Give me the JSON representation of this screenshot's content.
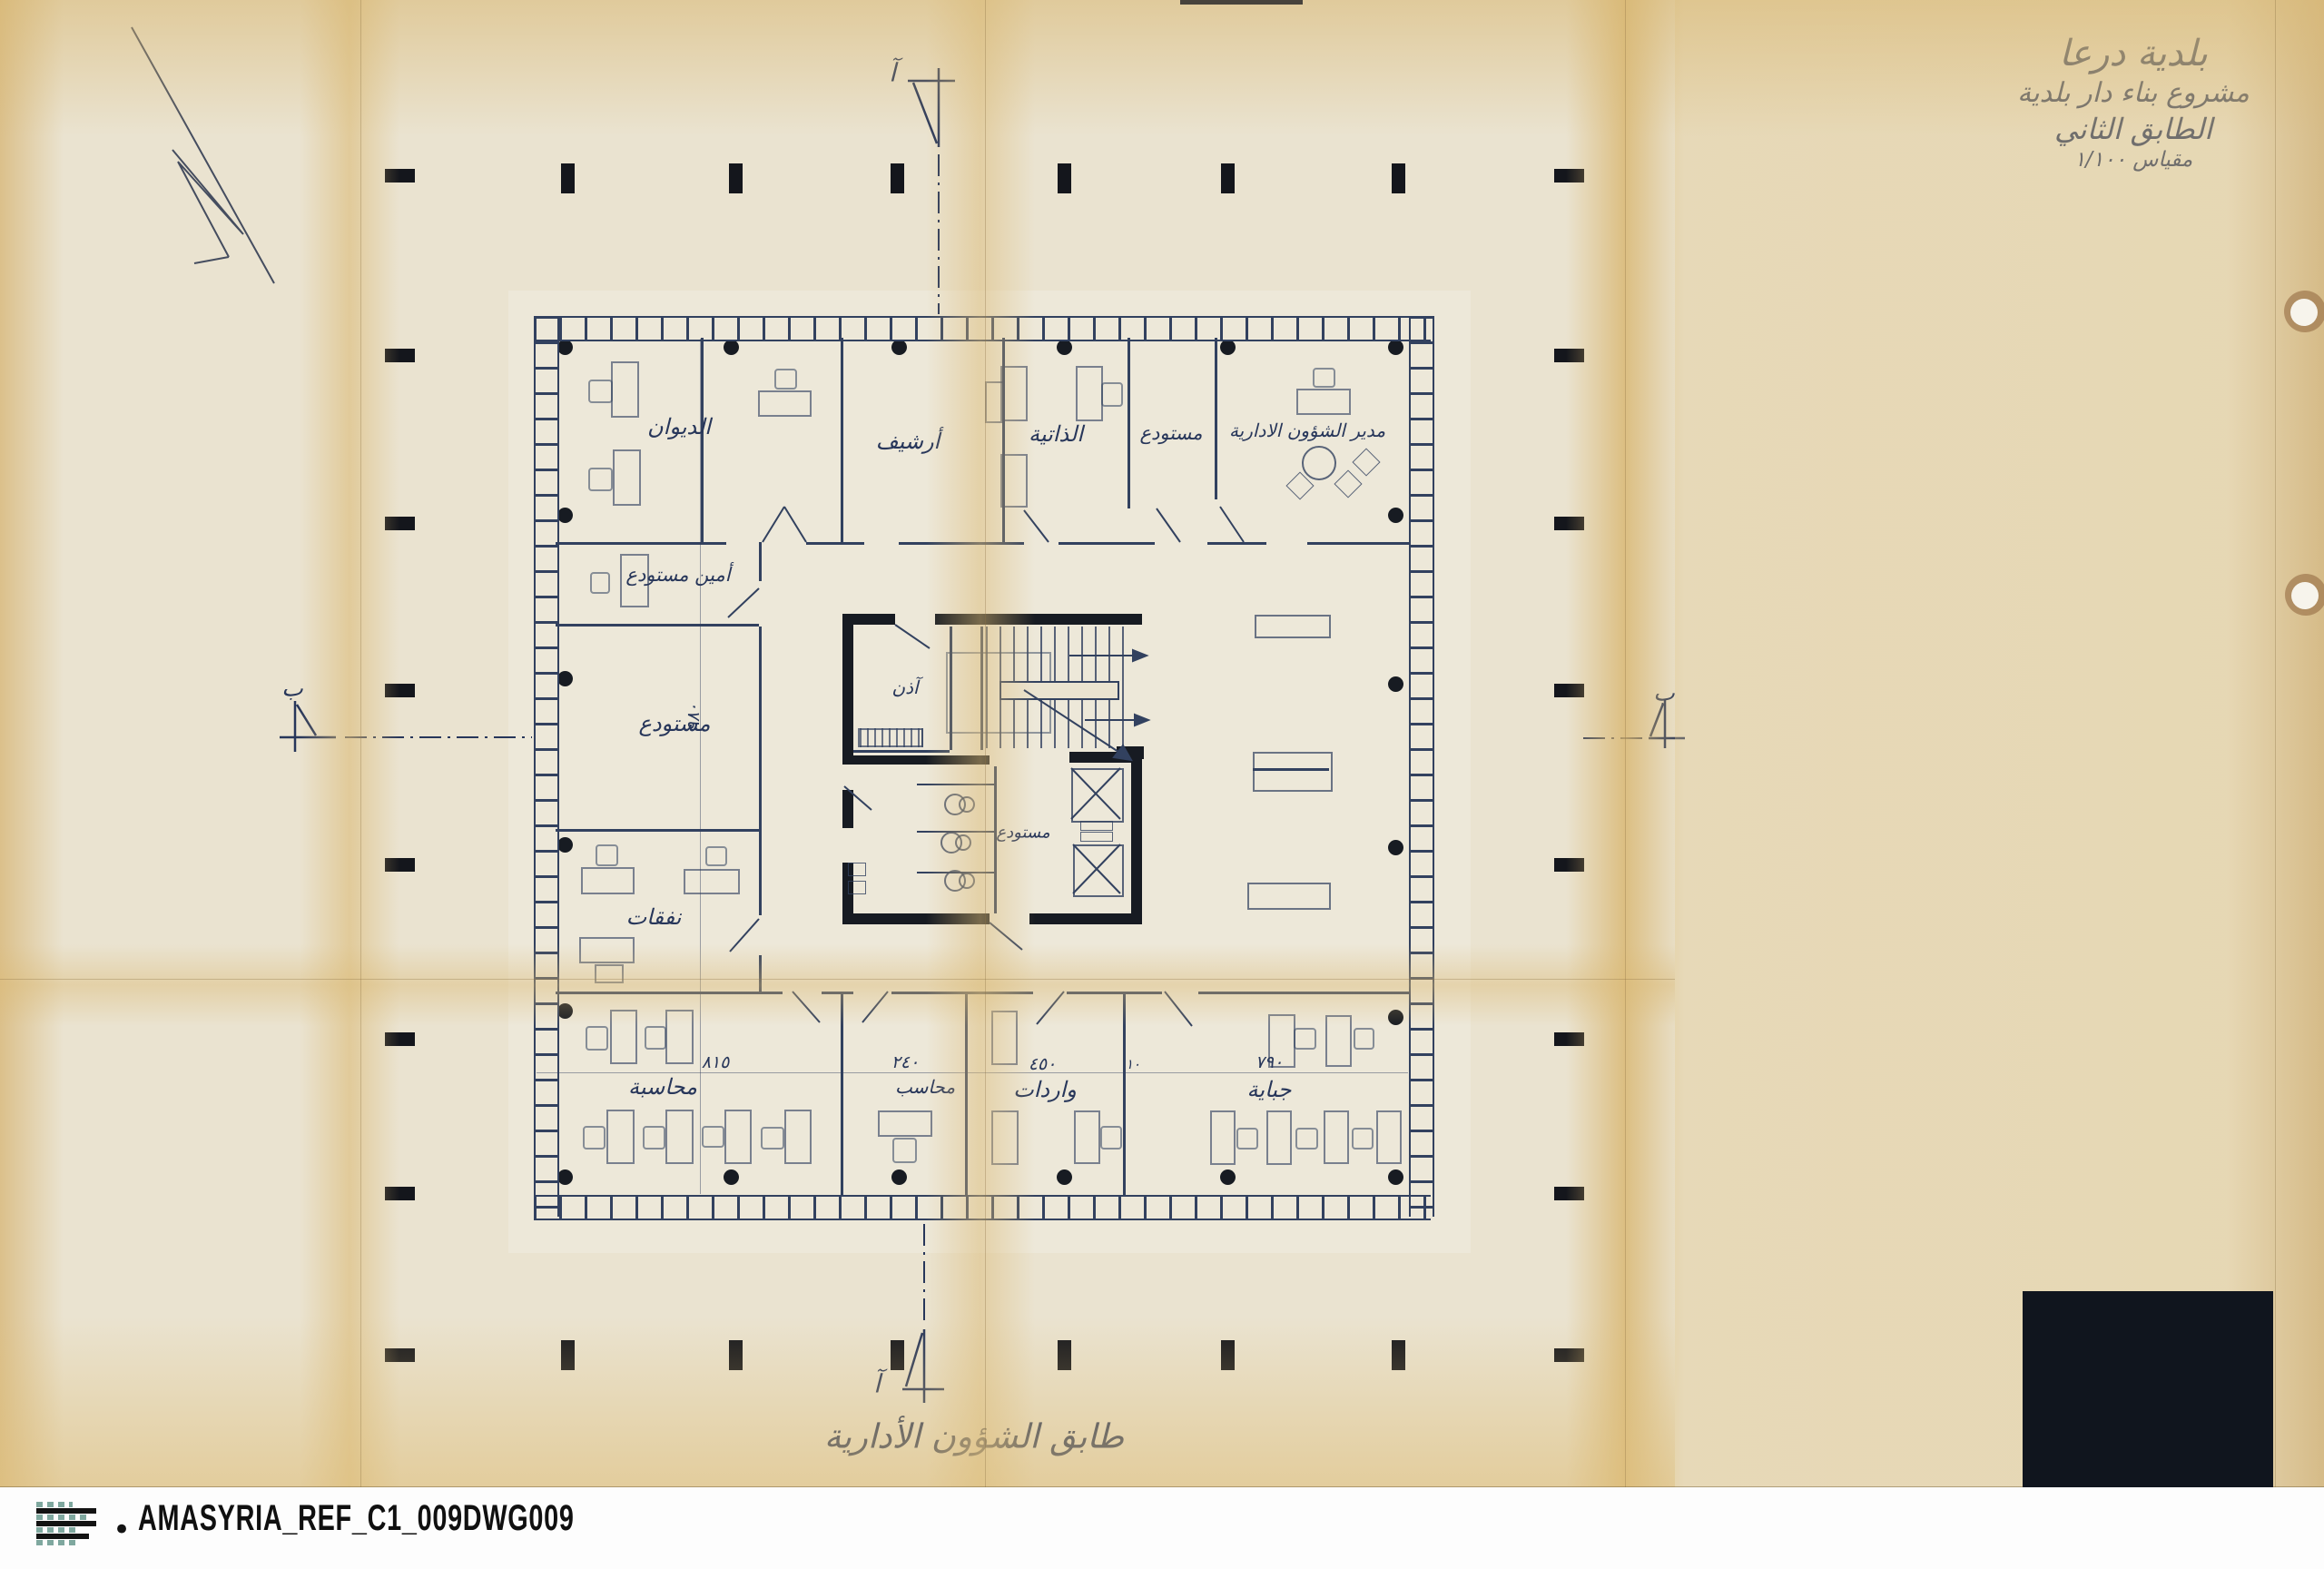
{
  "title_block": {
    "line1": "بلدية درعا",
    "line2": "مشروع بناء دار بلدية",
    "line3": "الطابق الثاني",
    "line4": "مقياس ١/١٠٠"
  },
  "plan_caption": "طابق الشؤون الأدارية",
  "section_markers": {
    "top": "آ",
    "bottom": "آ",
    "left": "ب",
    "right": "ب"
  },
  "rooms": {
    "diwan": "الديوان",
    "archive": "أرشيف",
    "dhatiya": "الذاتية",
    "storage_small": "مستودع",
    "director": "مدير الشؤون الادارية",
    "storekeeper": "أمين مستودع",
    "storage_large": "مستودع",
    "expenses": "نفقات",
    "attendant": "آذن",
    "storage_core": "مستودع",
    "accounting": "محاسبة",
    "accountant": "محاسب",
    "revenues": "واردات",
    "collection": "جباية"
  },
  "dimensions": {
    "accounting": "٨١٥",
    "accountant": "٢٤٠",
    "revenues": "٤٥٠",
    "partition": "١٠",
    "collection": "٧٩٠",
    "storage_large": "٩٨٠"
  },
  "footer": {
    "bullet": "•",
    "reference": "AMASYRIA_REF_C1_009DWG009"
  },
  "colors": {
    "paper": "#eae3d0",
    "stain": "#dfc286",
    "ink": "#32415f",
    "black": "#171b22",
    "footer_bg": "#fdfdfd",
    "footer_text": "#101010",
    "logo_teal": "#7fa89f"
  }
}
